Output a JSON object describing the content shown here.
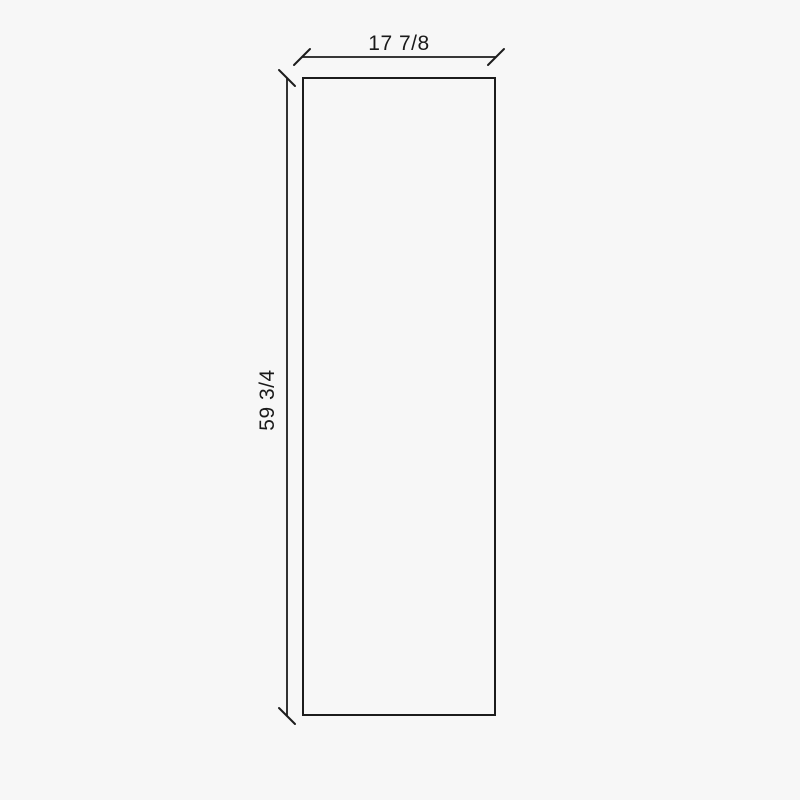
{
  "page": {
    "background_color": "#f7f7f7"
  },
  "drawing": {
    "type": "dimensioned-panel-drawing",
    "width_label": "17 7/8",
    "height_label": "59 3/4",
    "line_color": "#1c1c1c",
    "text_color": "#1a1a1a"
  }
}
